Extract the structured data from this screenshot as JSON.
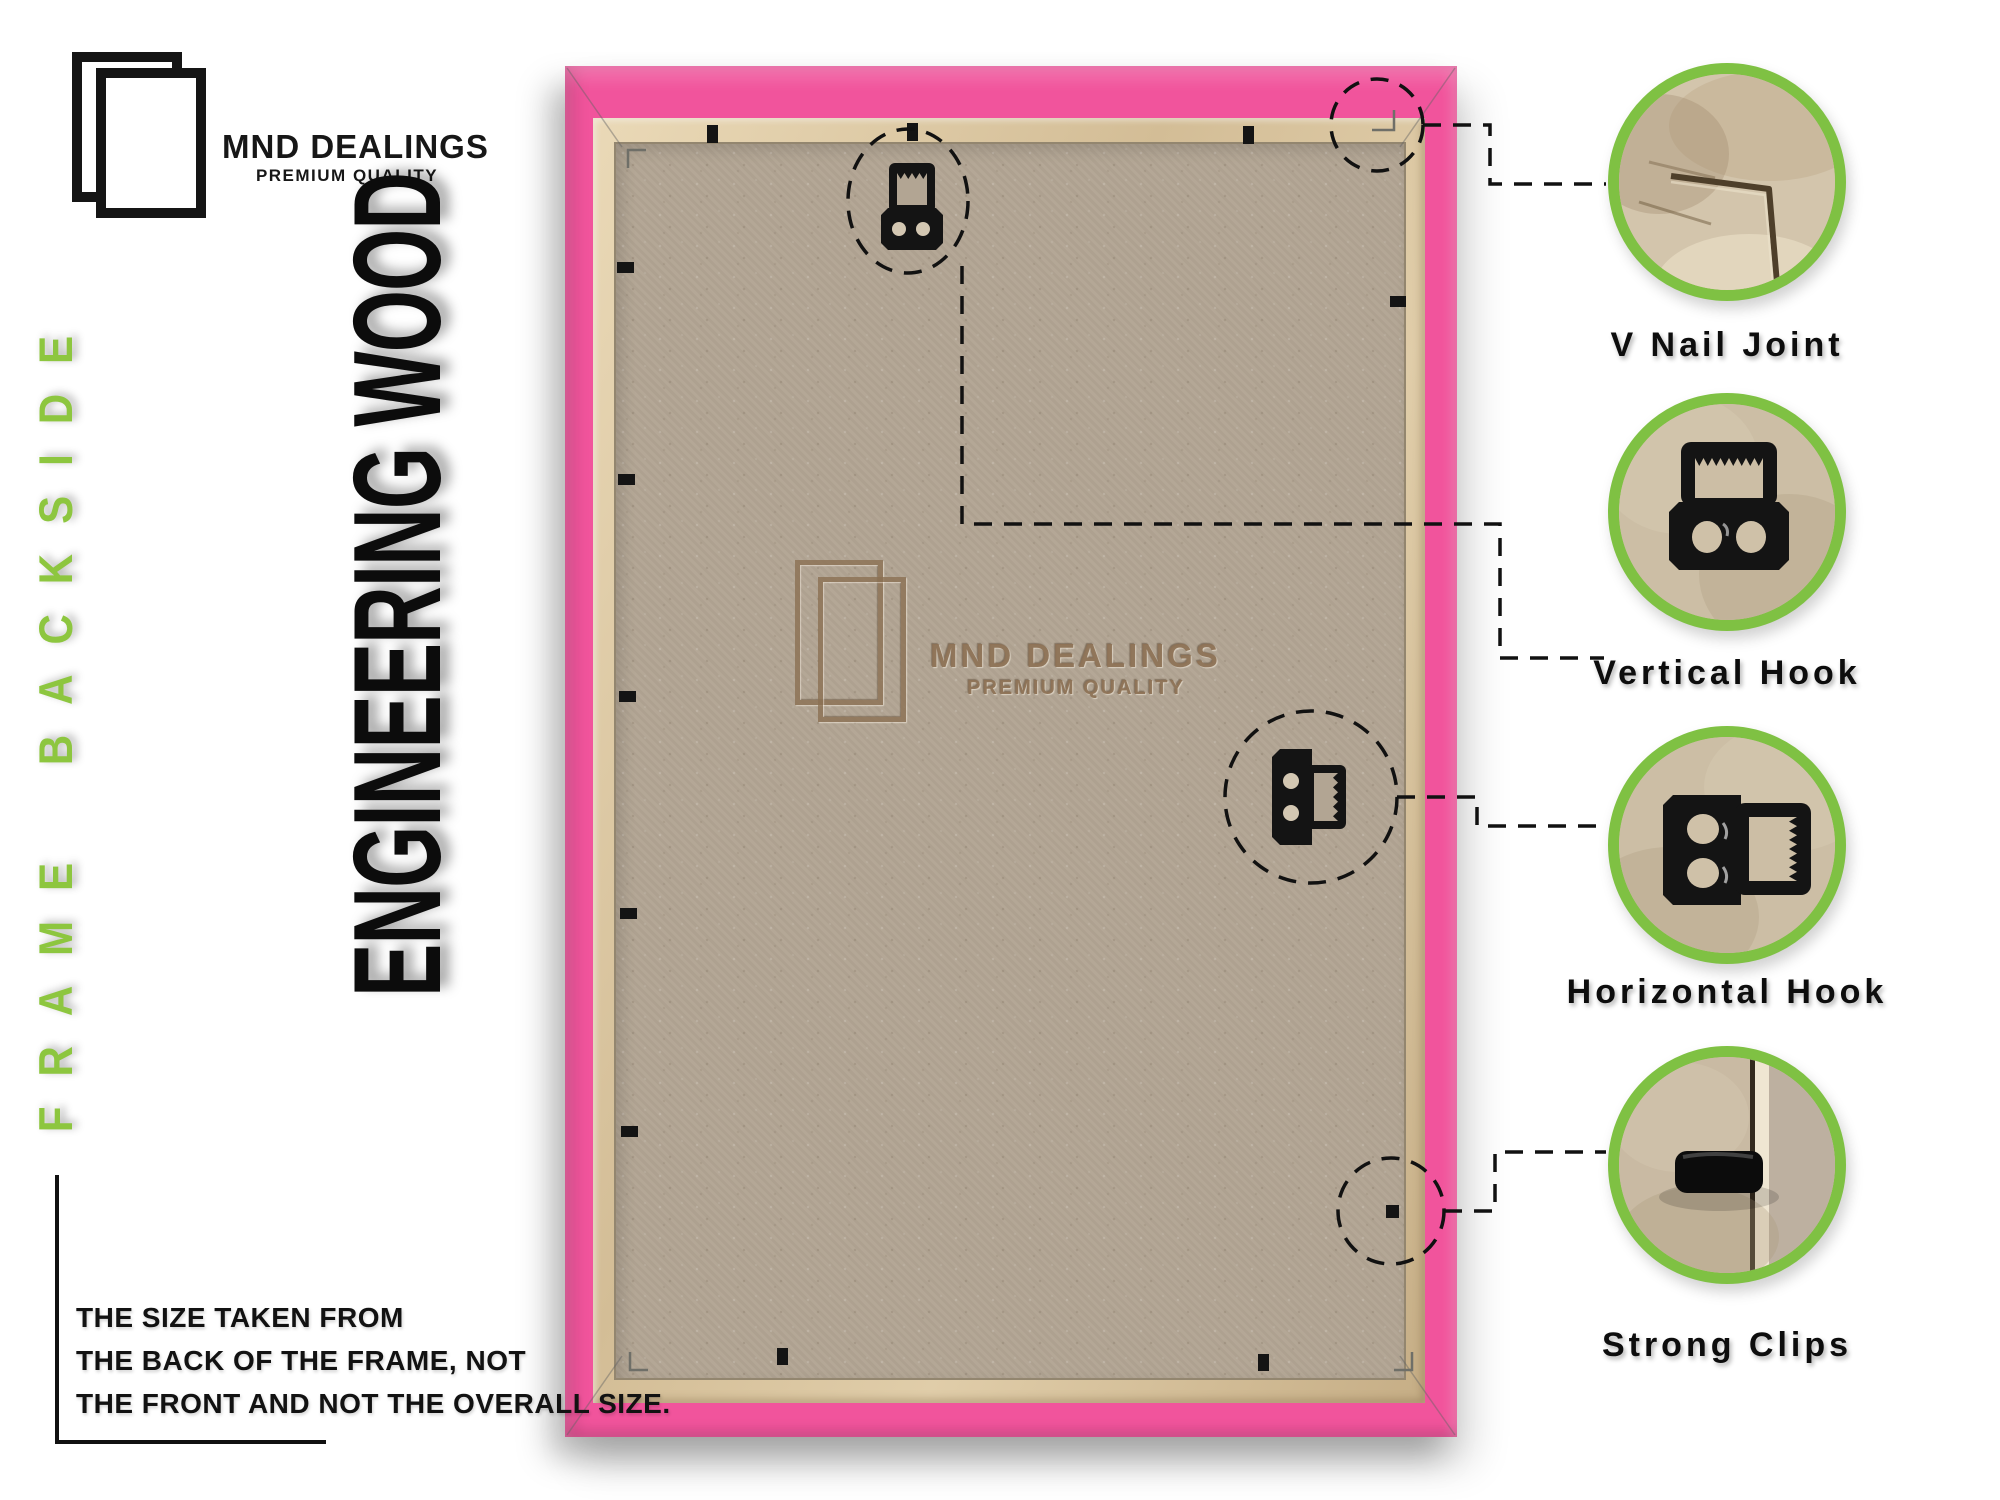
{
  "brand": {
    "name": "MND DEALINGS",
    "tagline": "PREMIUM QUALITY",
    "logo_icon": "double-frame-icon"
  },
  "side_label": "FRAME BACKSIDE",
  "material_label": "ENGINEERING WOOD",
  "watermark": {
    "name": "MND DEALINGS",
    "tagline": "PREMIUM QUALITY",
    "logo_icon": "double-frame-icon"
  },
  "callouts": [
    {
      "label": "V Nail Joint",
      "icon": "v-nail-joint-photo"
    },
    {
      "label": "Vertical Hook",
      "icon": "vertical-hook-photo"
    },
    {
      "label": "Horizontal Hook",
      "icon": "horizontal-hook-photo"
    },
    {
      "label": "Strong Clips",
      "icon": "strong-clip-photo"
    }
  ],
  "footnote": {
    "lines": [
      "THE SIZE TAKEN FROM",
      "THE BACK OF THE FRAME, NOT",
      "THE FRONT AND NOT THE OVERALL SIZE."
    ]
  },
  "colors": {
    "accent_green": "#8dc63f",
    "ring_green": "#7fc143",
    "frame_pink": "#f1549c",
    "lip_tan": "#d9c6a4",
    "board": "#b2a593",
    "ink": "#111111"
  }
}
